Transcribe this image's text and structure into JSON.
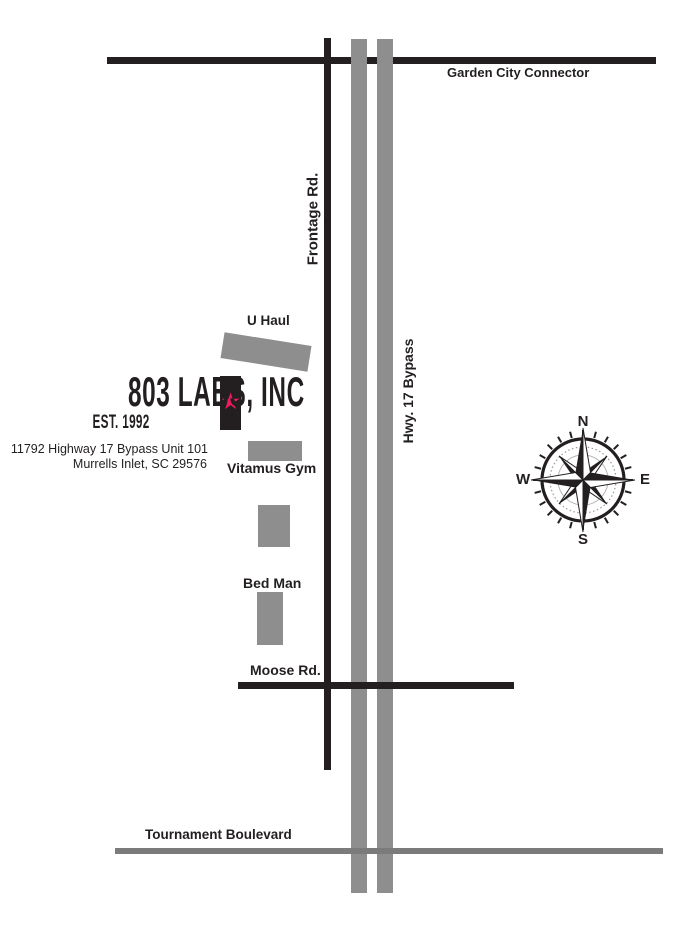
{
  "colors": {
    "ink": "#231f20",
    "gray-road": "#8e8e8e",
    "gray-road-dark": "#7b7b7b",
    "star-pink": "#ee1b5e"
  },
  "logo": {
    "title": "803 LABS, INC",
    "est": "EST. 1992",
    "address1": "11792 Highway 17 Bypass Unit 101",
    "address2": "Murrells Inlet, SC 29576"
  },
  "roads": {
    "garden_city": "Garden City Connector",
    "frontage": "Frontage Rd.",
    "hwy17": "Hwy. 17 Bypass",
    "moose": "Moose Rd.",
    "tournament": "Tournament Boulevard"
  },
  "landmarks": {
    "uhaul": "U Haul",
    "vitamus_gym": "Vitamus Gym",
    "bed_man": "Bed Man"
  },
  "compass": {
    "north": "N",
    "south": "S",
    "east": "E",
    "west": "W"
  },
  "icons": {
    "star": "★"
  }
}
